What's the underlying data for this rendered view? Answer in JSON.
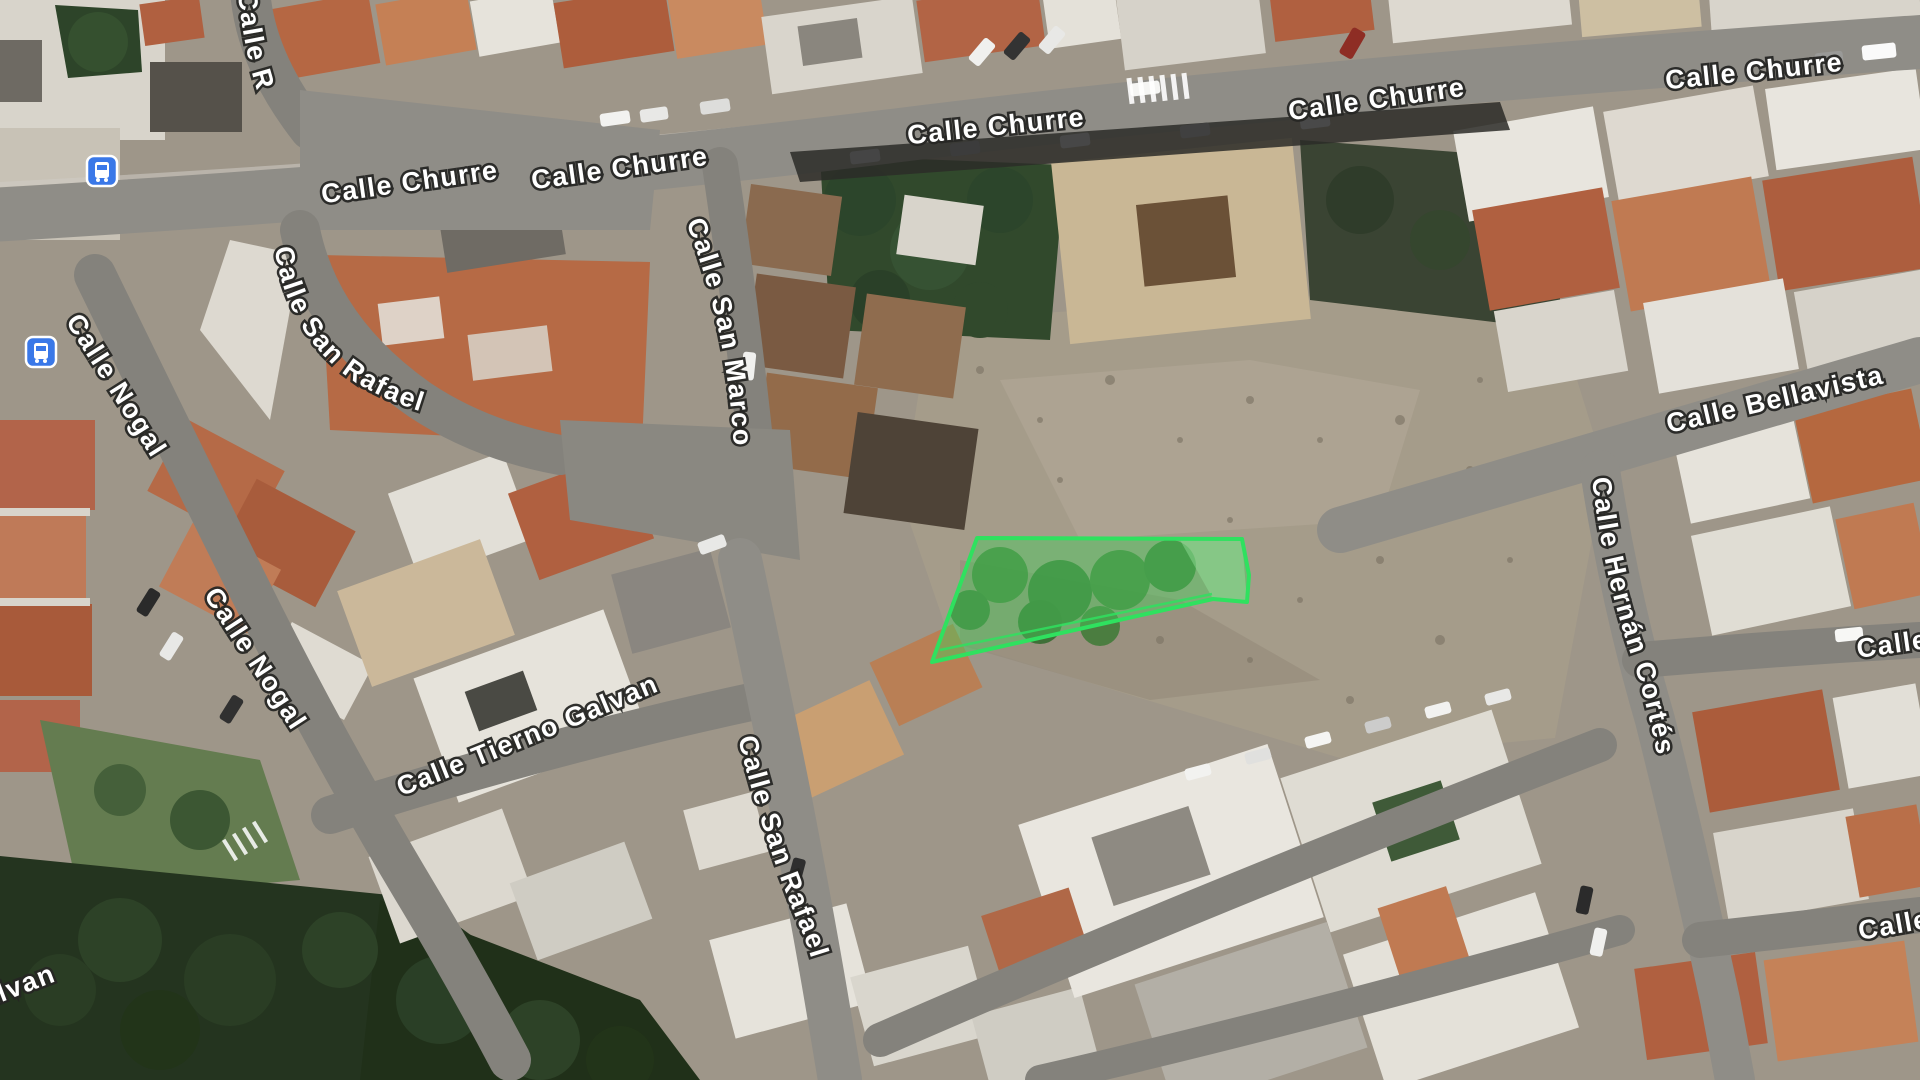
{
  "map": {
    "view_type": "satellite",
    "labels": [
      {
        "name": "calle-r",
        "text": "Calle R"
      },
      {
        "name": "calle-churre-1",
        "text": "Calle Churre"
      },
      {
        "name": "calle-churre-2",
        "text": "Calle Churre"
      },
      {
        "name": "calle-churre-3",
        "text": "Calle Churre"
      },
      {
        "name": "calle-churre-4",
        "text": "Calle Churre"
      },
      {
        "name": "calle-churre-5",
        "text": "Calle Churre"
      },
      {
        "name": "calle-san-marcos",
        "text": "Calle San Marcos"
      },
      {
        "name": "calle-san-rafael-upper",
        "text": "Calle San Rafael"
      },
      {
        "name": "calle-nogal-1",
        "text": "Calle Nogal"
      },
      {
        "name": "calle-nogal-2",
        "text": "Calle Nogal"
      },
      {
        "name": "calle-tierno-galvan",
        "text": "Calle Tierno Galvan"
      },
      {
        "name": "calle-san-rafael-lower",
        "text": "Calle San Rafael"
      },
      {
        "name": "calle-bellavista",
        "text": "Calle Bellavista"
      },
      {
        "name": "calle-hernan-cortes",
        "text": "Calle Hernán Cortés"
      },
      {
        "name": "partial-right-upper",
        "text": "Calle"
      },
      {
        "name": "partial-right-lower",
        "text": "Calle"
      },
      {
        "name": "partial-left-galvan",
        "text": "alvan"
      }
    ],
    "parcel": {
      "points": "977,538 1242,539 1249,575 1247,602 1213,599 932,662",
      "inner_line_points": "940,650 1212,594",
      "fill": "rgba(70,205,92,0.45)",
      "stroke": "#2fe15f"
    },
    "icons": {
      "bus_stop_1": {
        "name": "bus-stop-icon",
        "color": "#3a78e8"
      },
      "bus_stop_2": {
        "name": "bus-stop-icon",
        "color": "#3a78e8"
      }
    },
    "colors": {
      "road": "#8f8d87",
      "dirt_lot": "#a59c8a",
      "roof_terracotta": "#b06040",
      "trees_dark": "#24341f",
      "building_white": "#e9e6df"
    }
  }
}
